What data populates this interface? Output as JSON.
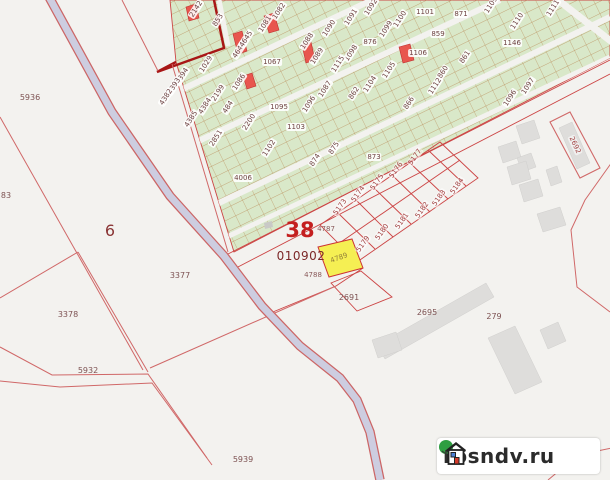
{
  "map": {
    "title": "cadastral-map-view",
    "quarter": {
      "number": "38",
      "code": "010902"
    },
    "highlighted_parcel": {
      "label": "4789",
      "fill": "#f5ef53"
    },
    "labels": [
      {
        "t": "2142",
        "x": 196,
        "y": 9,
        "r": -57
      },
      {
        "t": "853",
        "x": 218,
        "y": 20,
        "r": -57
      },
      {
        "t": "1082",
        "x": 279,
        "y": 11,
        "r": -57
      },
      {
        "t": "1081",
        "x": 265,
        "y": 24,
        "r": -57
      },
      {
        "t": "1090",
        "x": 329,
        "y": 28,
        "r": -57
      },
      {
        "t": "1091",
        "x": 351,
        "y": 17,
        "r": -57
      },
      {
        "t": "1092",
        "x": 371,
        "y": 7,
        "r": -57
      },
      {
        "t": "1088",
        "x": 307,
        "y": 41,
        "r": -57
      },
      {
        "t": "1089",
        "x": 317,
        "y": 56,
        "r": -57
      },
      {
        "t": "1098",
        "x": 351,
        "y": 53,
        "r": -57
      },
      {
        "t": "1115",
        "x": 338,
        "y": 64,
        "r": -57
      },
      {
        "t": "1029",
        "x": 206,
        "y": 64,
        "r": -57
      },
      {
        "t": "4644",
        "x": 239,
        "y": 50,
        "r": -57
      },
      {
        "t": "4645",
        "x": 246,
        "y": 39,
        "r": -57
      },
      {
        "t": "4394",
        "x": 182,
        "y": 76,
        "r": -57
      },
      {
        "t": "4393",
        "x": 174,
        "y": 86,
        "r": -57
      },
      {
        "t": "4382",
        "x": 166,
        "y": 97,
        "r": -57
      },
      {
        "t": "2199",
        "x": 218,
        "y": 93,
        "r": -57
      },
      {
        "t": "4384",
        "x": 205,
        "y": 106,
        "r": -57
      },
      {
        "t": "4385",
        "x": 191,
        "y": 119,
        "r": -57
      },
      {
        "t": "484",
        "x": 228,
        "y": 107,
        "r": -57
      },
      {
        "t": "1086",
        "x": 239,
        "y": 82,
        "r": -57
      },
      {
        "t": "2851",
        "x": 216,
        "y": 138,
        "r": -57
      },
      {
        "t": "2200",
        "x": 249,
        "y": 122,
        "r": -57
      },
      {
        "t": "1102",
        "x": 269,
        "y": 148,
        "r": -57
      },
      {
        "t": "874",
        "x": 315,
        "y": 160,
        "r": -57
      },
      {
        "t": "875",
        "x": 334,
        "y": 148,
        "r": -57
      },
      {
        "t": "1087",
        "x": 325,
        "y": 89,
        "r": -57
      },
      {
        "t": "1096",
        "x": 309,
        "y": 104,
        "r": -57
      },
      {
        "t": "1097",
        "x": 528,
        "y": 86,
        "r": -57
      },
      {
        "t": "1096",
        "x": 510,
        "y": 98,
        "r": -57
      },
      {
        "t": "1099",
        "x": 386,
        "y": 29,
        "r": -57
      },
      {
        "t": "1100",
        "x": 400,
        "y": 19,
        "r": -57
      },
      {
        "t": "1105",
        "x": 389,
        "y": 70,
        "r": -57
      },
      {
        "t": "1104",
        "x": 370,
        "y": 84,
        "r": -57
      },
      {
        "t": "862",
        "x": 354,
        "y": 93,
        "r": -57
      },
      {
        "t": "866",
        "x": 409,
        "y": 103,
        "r": -57
      },
      {
        "t": "860",
        "x": 443,
        "y": 72,
        "r": -57
      },
      {
        "t": "861",
        "x": 465,
        "y": 57,
        "r": -57
      },
      {
        "t": "1112",
        "x": 435,
        "y": 86,
        "r": -57
      },
      {
        "t": "1110",
        "x": 517,
        "y": 21,
        "r": -57
      },
      {
        "t": "1109",
        "x": 491,
        "y": 5,
        "r": -57
      },
      {
        "t": "1111",
        "x": 553,
        "y": 8,
        "r": -57
      },
      {
        "t": "1067",
        "x": 272,
        "y": 62,
        "r": 0
      },
      {
        "t": "1095",
        "x": 279,
        "y": 107,
        "r": 0
      },
      {
        "t": "1103",
        "x": 296,
        "y": 127,
        "r": 0
      },
      {
        "t": "873",
        "x": 374,
        "y": 157,
        "r": 0
      },
      {
        "t": "4006",
        "x": 243,
        "y": 178,
        "r": 0
      },
      {
        "t": "876",
        "x": 370,
        "y": 42,
        "r": 0
      },
      {
        "t": "859",
        "x": 438,
        "y": 34,
        "r": 0
      },
      {
        "t": "871",
        "x": 461,
        "y": 14,
        "r": 0
      },
      {
        "t": "1101",
        "x": 425,
        "y": 12,
        "r": 0
      },
      {
        "t": "1146",
        "x": 512,
        "y": 43,
        "r": 0
      },
      {
        "t": "1106",
        "x": 418,
        "y": 53,
        "r": 0
      },
      {
        "t": "5173",
        "x": 340,
        "y": 207,
        "r": -55,
        "c": "wr"
      },
      {
        "t": "5174",
        "x": 358,
        "y": 194,
        "r": -55,
        "c": "wr"
      },
      {
        "t": "5175",
        "x": 377,
        "y": 182,
        "r": -55,
        "c": "wr"
      },
      {
        "t": "5176",
        "x": 396,
        "y": 170,
        "r": -55,
        "c": "wr"
      },
      {
        "t": "5177",
        "x": 415,
        "y": 157,
        "r": -55,
        "c": "wr"
      },
      {
        "t": "5179",
        "x": 363,
        "y": 244,
        "r": -55,
        "c": "wr"
      },
      {
        "t": "5180",
        "x": 382,
        "y": 232,
        "r": -55,
        "c": "wr"
      },
      {
        "t": "5181",
        "x": 402,
        "y": 221,
        "r": -55,
        "c": "wr"
      },
      {
        "t": "5182",
        "x": 422,
        "y": 210,
        "r": -55,
        "c": "wr"
      },
      {
        "t": "5183",
        "x": 439,
        "y": 198,
        "r": -55,
        "c": "wr"
      },
      {
        "t": "5184",
        "x": 457,
        "y": 186,
        "r": -55,
        "c": "wr"
      },
      {
        "t": "2692",
        "x": 575,
        "y": 145,
        "r": 65,
        "c": "wr"
      },
      {
        "t": "38",
        "x": 300,
        "y": 230,
        "r": 0,
        "c": "q38"
      },
      {
        "t": "010902",
        "x": 301,
        "y": 256,
        "r": 0,
        "c": "qcode"
      },
      {
        "t": "4787",
        "x": 326,
        "y": 229,
        "r": 0,
        "c": "tiny"
      },
      {
        "t": "4789",
        "x": 339,
        "y": 258,
        "r": -20,
        "c": "ylabel"
      },
      {
        "t": "4788",
        "x": 313,
        "y": 275,
        "r": 0,
        "c": "tiny"
      },
      {
        "t": "2691",
        "x": 349,
        "y": 298,
        "r": 0,
        "c": "plain"
      },
      {
        "t": "2695",
        "x": 427,
        "y": 313,
        "r": 0,
        "c": "plain"
      },
      {
        "t": "279",
        "x": 494,
        "y": 317,
        "r": 0,
        "c": "plain"
      },
      {
        "t": "5936",
        "x": 30,
        "y": 98,
        "r": 0,
        "c": "plain"
      },
      {
        "t": "83",
        "x": 6,
        "y": 196,
        "r": 0,
        "c": "plain"
      },
      {
        "t": "6",
        "x": 110,
        "y": 231,
        "r": 0,
        "c": "six"
      },
      {
        "t": "3377",
        "x": 180,
        "y": 276,
        "r": 0,
        "c": "plain"
      },
      {
        "t": "3378",
        "x": 68,
        "y": 315,
        "r": 0,
        "c": "plain"
      },
      {
        "t": "5932",
        "x": 88,
        "y": 371,
        "r": 0,
        "c": "plain"
      },
      {
        "t": "5939",
        "x": 243,
        "y": 460,
        "r": 0,
        "c": "plain"
      }
    ]
  },
  "watermark": {
    "text": "rosndv.ru"
  },
  "colors": {
    "bg": "#f3f2ef",
    "green": "#d9e8c9",
    "gridTan": "#b98a55",
    "lineRed": "#d06868",
    "blockRed": "#cc4444",
    "thickRed": "#a81616",
    "roadFill": "#cdcde0",
    "roadCase": "#cc6666",
    "redBold": "#c41f1f",
    "redFill": "#e8564e",
    "building": "#dedddb",
    "yellow": "#f5ef53"
  }
}
